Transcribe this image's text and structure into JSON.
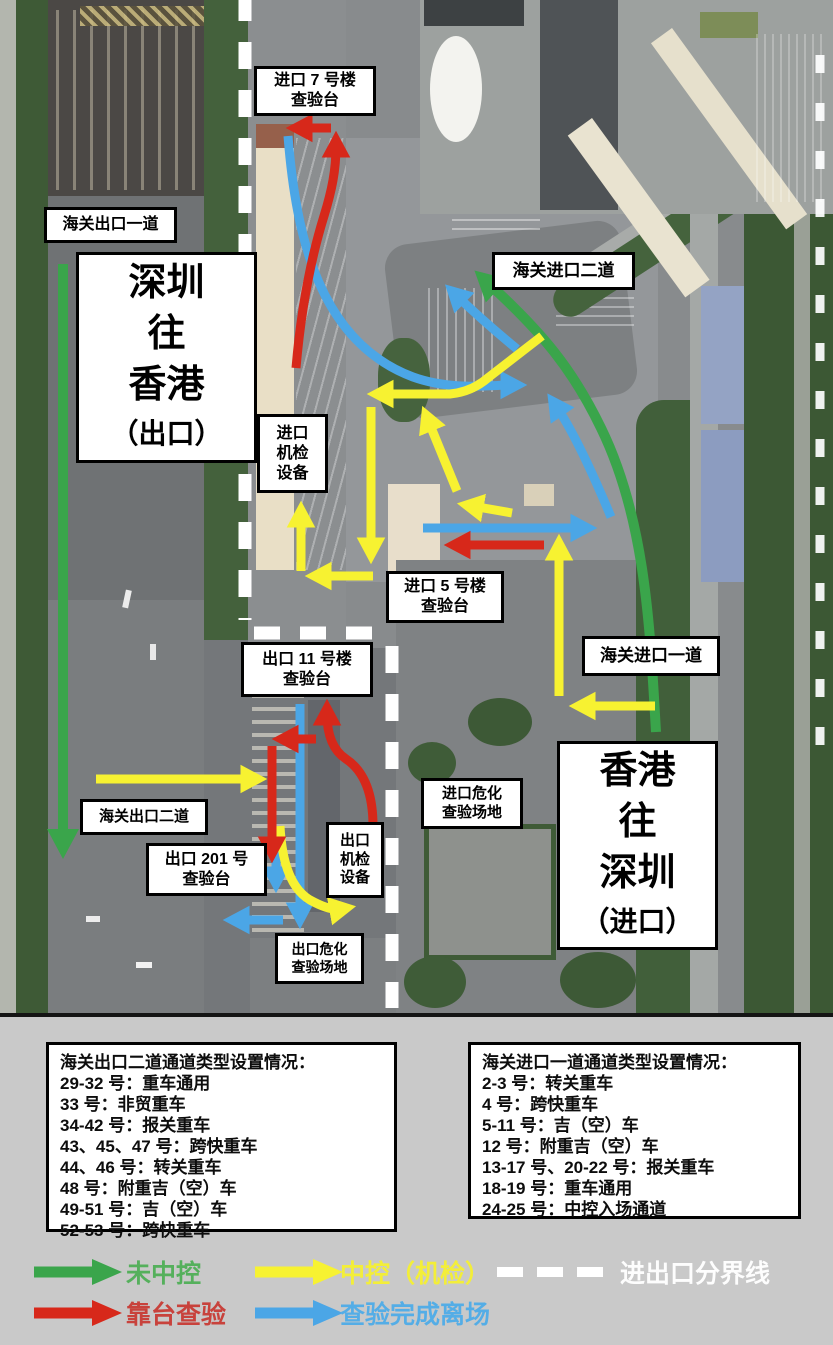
{
  "colors": {
    "green": "#3aa54b",
    "yellow": "#f7f231",
    "red": "#d7281a",
    "blue": "#4ba6e6",
    "white": "#ffffff"
  },
  "map": {
    "labels": {
      "import_bldg7": [
        "进口 7 号楼",
        "查验台"
      ],
      "customs_exit_lane1": [
        "海关出口一道"
      ],
      "zone_export": [
        "深圳",
        "往",
        "香港",
        "（出口）"
      ],
      "customs_entry_lane2": [
        "海关进口二道"
      ],
      "import_scan": [
        "进口",
        "机检",
        "设备"
      ],
      "import_bldg5": [
        "进口 5 号楼",
        "查验台"
      ],
      "customs_entry_lane1": [
        "海关进口一道"
      ],
      "export_bldg11": [
        "出口 11 号楼",
        "查验台"
      ],
      "import_hazmat": [
        "进口危化",
        "查验场地"
      ],
      "zone_import": [
        "香港",
        "往",
        "深圳",
        "（进口）"
      ],
      "customs_exit_lane2": [
        "海关出口二道"
      ],
      "export_bldg201": [
        "出口 201 号",
        "查验台"
      ],
      "export_scan": [
        "出口",
        "机检",
        "设备"
      ],
      "export_hazmat": [
        "出口危化",
        "查验场地"
      ]
    }
  },
  "info_boxes": {
    "exit": {
      "title": "海关出口二道通道类型设置情况：",
      "rows": [
        "29-32 号：重车通用",
        "33 号：非贸重车",
        "34-42 号：报关重车",
        "43、45、47 号：跨快重车",
        "44、46 号：转关重车",
        "48 号：附重吉（空）车",
        "49-51 号：吉（空）车",
        "52-53 号：跨快重车"
      ]
    },
    "entry": {
      "title": "海关进口一道通道类型设置情况：",
      "rows": [
        "2-3 号：转关重车",
        "4 号：跨快重车",
        "5-11 号：吉（空）车",
        "12 号：附重吉（空）车",
        "13-17 号、20-22 号：报关重车",
        "18-19 号：重车通用",
        "24-25 号：中控入场通道"
      ]
    }
  },
  "legend": {
    "uncontrolled": "未中控",
    "controlled": "中控（机检）",
    "boundary": "进出口分界线",
    "dock_inspection": "靠台查验",
    "depart": "查验完成离场"
  }
}
